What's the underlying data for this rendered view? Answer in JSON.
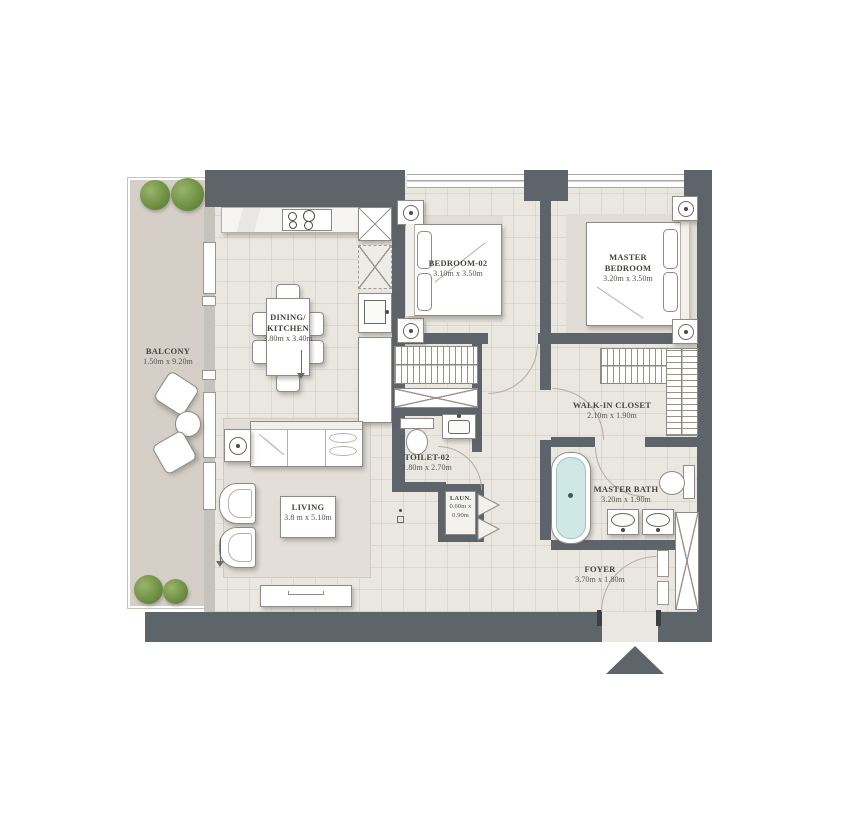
{
  "floorplan": {
    "type": "apartment-floor-plan",
    "colors": {
      "wall": "#5d646a",
      "floor": "#eae7e1",
      "balcony_floor": "#d5cfc7",
      "bed_area_shade": "#e1ddd6",
      "tub_water": "#cfe7e5",
      "tree_green": "#6c8f42",
      "label_text": "#45443f"
    },
    "rooms": {
      "balcony": {
        "name": "BALCONY",
        "dims": "1.50m x 9.20m"
      },
      "dining_kitchen": {
        "name": "DINING/ KITCHEN",
        "dims": "3.80m x 3.40m"
      },
      "bedroom02": {
        "name": "BEDROOM-02",
        "dims": "3.10m x 3.50m"
      },
      "master_bedroom": {
        "name": "MASTER BEDROOM",
        "dims": "3.20m x 3.50m"
      },
      "walk_in_closet": {
        "name": "WALK-IN CLOSET",
        "dims": "2.10m x 1.90m"
      },
      "toilet02": {
        "name": "TOILET-02",
        "dims": "1.80m x 2.70m"
      },
      "laundry": {
        "name": "LAUN.",
        "dims": "0.60m x 0.90m"
      },
      "master_bath": {
        "name": "MASTER BATH",
        "dims": "3.20m x 1.90m"
      },
      "living": {
        "name": "LIVING",
        "dims": "3.8 m x 5.10m"
      },
      "foyer": {
        "name": "FOYER",
        "dims": "3.70m x 1.80m"
      }
    },
    "icons": {
      "entrance_arrow": "triangle-up"
    }
  }
}
